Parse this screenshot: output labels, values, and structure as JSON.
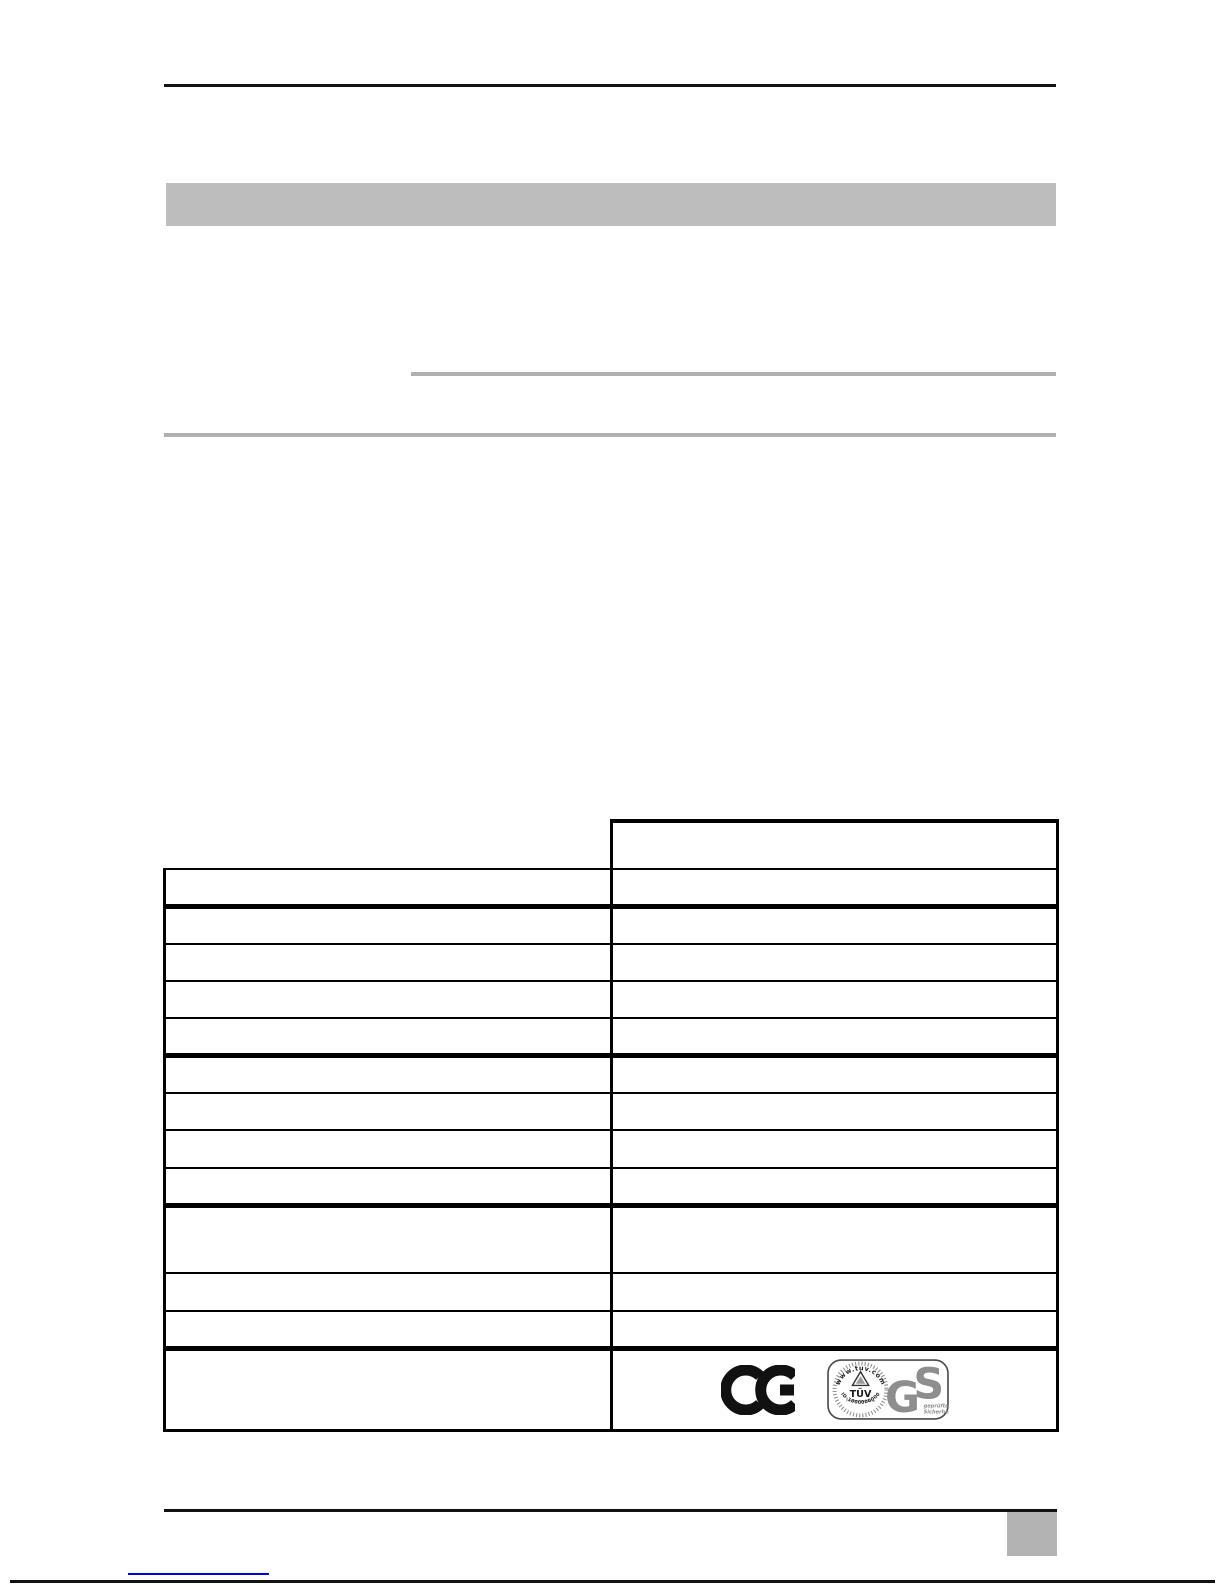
{
  "document": {
    "kind": "manual-specification-page",
    "visible_body_text": "",
    "table": {
      "column_count": 2,
      "data_row_count": 13,
      "cells_text": ""
    }
  },
  "logos": {
    "ce": {
      "label": "CE"
    },
    "tuv": {
      "top_arc": "www.tuv.com",
      "title": "TÜV",
      "subtitle": "TÜV Rheinland Group",
      "bottom_arc": "ID-1000000000"
    },
    "gs": {
      "letter_g": "G",
      "letter_s": "S",
      "caption_line1": "geprüfte",
      "caption_line2": "Sicherheit"
    }
  },
  "colors": {
    "page_bg": "#ffffff",
    "ink": "#111111",
    "header_bar": "#bdbdbd",
    "rule_gray": "#b0b0b0",
    "page_marker": "#b3b3b3",
    "link_blue": "#0000dd",
    "gs_gray": "#8e8e8e"
  }
}
